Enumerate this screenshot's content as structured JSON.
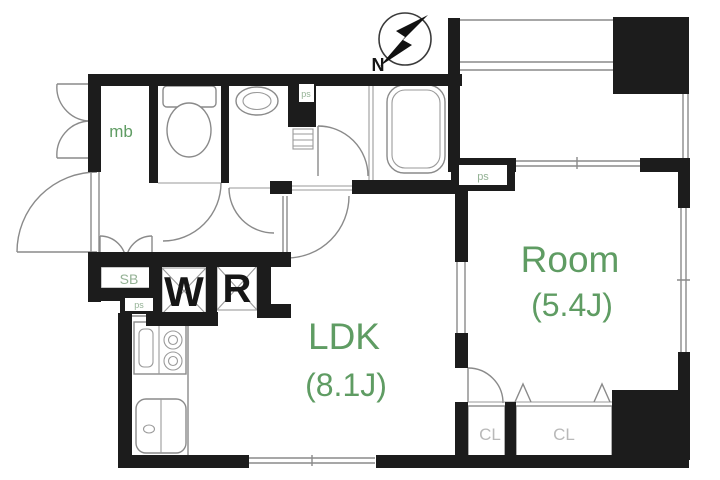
{
  "floorplan": {
    "compass": {
      "north_label": "N"
    },
    "rooms": {
      "ldk": {
        "name": "LDK",
        "size": "(8.1J)"
      },
      "room": {
        "name": "Room",
        "size": "(5.4J)"
      }
    },
    "labels": {
      "meter_box": "mb",
      "shoe_box": "SB",
      "pipe_space": "ps",
      "washing_machine": "W",
      "refrigerator": "R",
      "closet": "CL"
    },
    "colors": {
      "wall": "#1c1c1c",
      "label_green": "#5f9c63",
      "label_pale_green": "#94b295",
      "label_gray": "#b9b9b9",
      "line_gray": "#8a8a8a",
      "background": "#ffffff"
    }
  }
}
